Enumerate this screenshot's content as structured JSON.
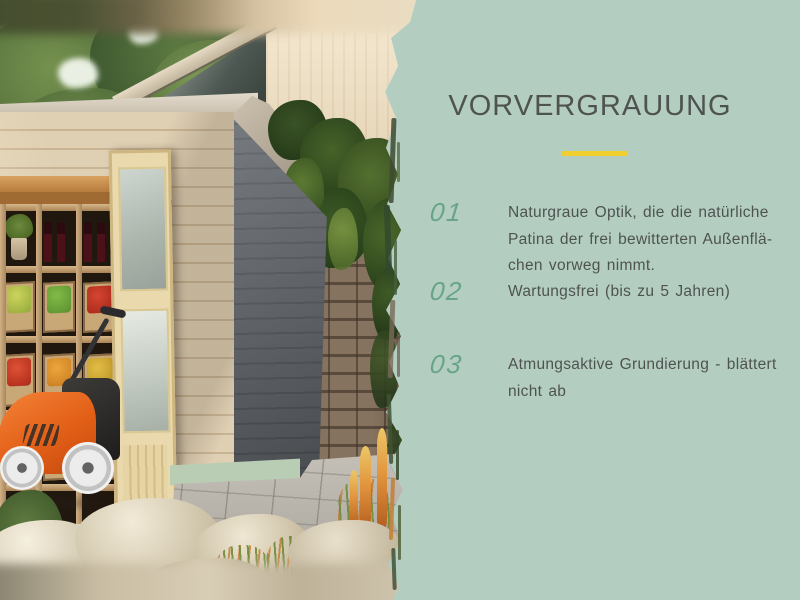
{
  "slide": {
    "title": "VORVERGRAUUNG",
    "items": [
      {
        "number": "01",
        "lines": [
          "Naturgraue Optik, die die natürliche",
          "Patina der frei bewitterten Außenflä-",
          "chen vorweg nimmt."
        ]
      },
      {
        "number": "02",
        "lines": [
          "Wartungsfrei (bis zu 5 Jahren)"
        ]
      },
      {
        "number": "03",
        "lines": [
          "Atmungsaktive Grundierung - blättert",
          "nicht ab"
        ]
      }
    ]
  },
  "colors": {
    "panel_background": "#b3cec1",
    "accent_yellow": "#f0cf2e",
    "number_green": "#68a487",
    "text_gray": "#4e5350"
  },
  "photo_alt": "Graues Gartenhaus mit Regal, Obstkisten, Weinflaschen und orangem Rasenmäher vor Steinmauer"
}
